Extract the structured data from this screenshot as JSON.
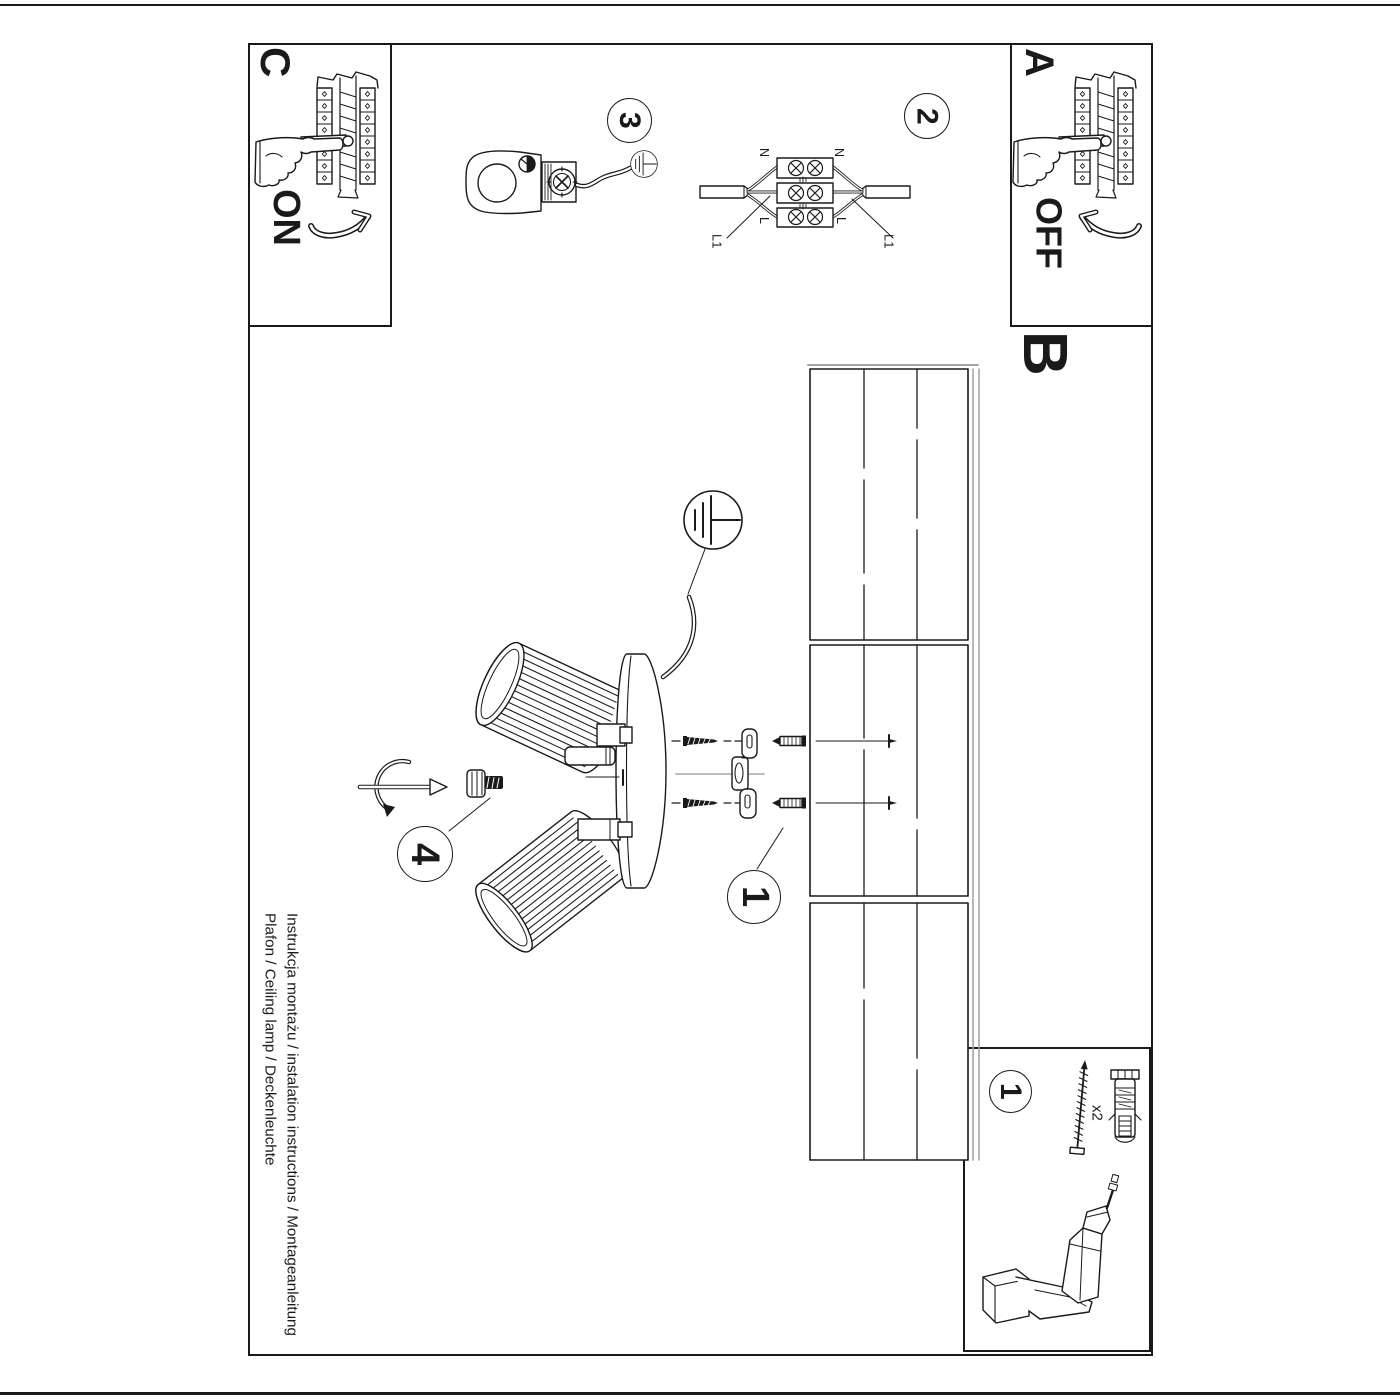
{
  "page": {
    "instructions_line1": "Instrukcja montażu / instalation instructions / Montageanleitung",
    "instructions_line2": "Plafon / Ceiling lamp / Deckenleuchte"
  },
  "sections": {
    "a_label": "A",
    "b_label": "B",
    "c_label": "C",
    "power_off": "OFF",
    "power_on": "ON"
  },
  "steps": {
    "assembly_step": "1",
    "wiring_step": "2",
    "clamp_step": "3",
    "shade_step": "4",
    "parts_step": "1"
  },
  "wiring_labels": {
    "neutral_left": "N",
    "neutral_right": "N",
    "live_left": "L",
    "live_right": "L",
    "line_left": "L1",
    "line_right": "L1"
  },
  "parts": {
    "quantity": "x2"
  },
  "colors": {
    "ink": "#1a1a1a",
    "shadow": "#a6a6a6",
    "paper": "#ffffff"
  },
  "icons": {
    "earth_icon": "earth-ground-icon",
    "breaker_icon": "circuit-breaker-icon",
    "hand_icon": "pointing-hand-icon",
    "drill_icon": "drill-icon",
    "screw_icon": "screw-icon",
    "plug_icon": "wall-plug-icon"
  }
}
